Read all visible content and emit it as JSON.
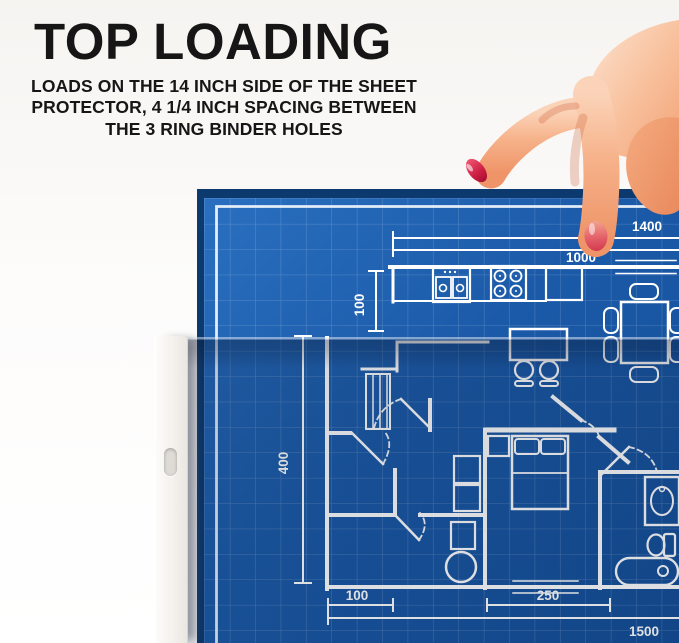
{
  "header": {
    "title": "TOP LOADING",
    "subtitle_line1": "LOADS ON THE 14 INCH SIDE OF THE SHEET",
    "subtitle_line2": "PROTECTOR, 4 1/4 INCH SPACING BETWEEN",
    "subtitle_line3": "THE 3 RING BINDER HOLES"
  },
  "blueprint": {
    "description": "house floor plan blueprint being inserted into sheet protector",
    "dimension_labels": {
      "top_width": "1400",
      "upper_width": "1000",
      "kitchen_depth": "100",
      "left_height": "400",
      "bottom_left_width": "100",
      "bottom_middle_width": "250",
      "bottom_total_width": "1500"
    }
  },
  "sheet_protector": {
    "binder_holes_visible": 1
  },
  "colors": {
    "background": "#fbfaf8",
    "title_text": "#161616",
    "blueprint_blue": "#1b5aa8",
    "blueprint_blue_dark": "#134d96",
    "blueprint_edge_navy": "#0d3a6e",
    "blueprint_line": "#ffffff",
    "protector_strip": "#f4f1ec",
    "nail_red": "#c42444",
    "skin_light": "#fcd9c2",
    "skin_mid": "#f5ab84",
    "skin_deep": "#e8825a"
  }
}
